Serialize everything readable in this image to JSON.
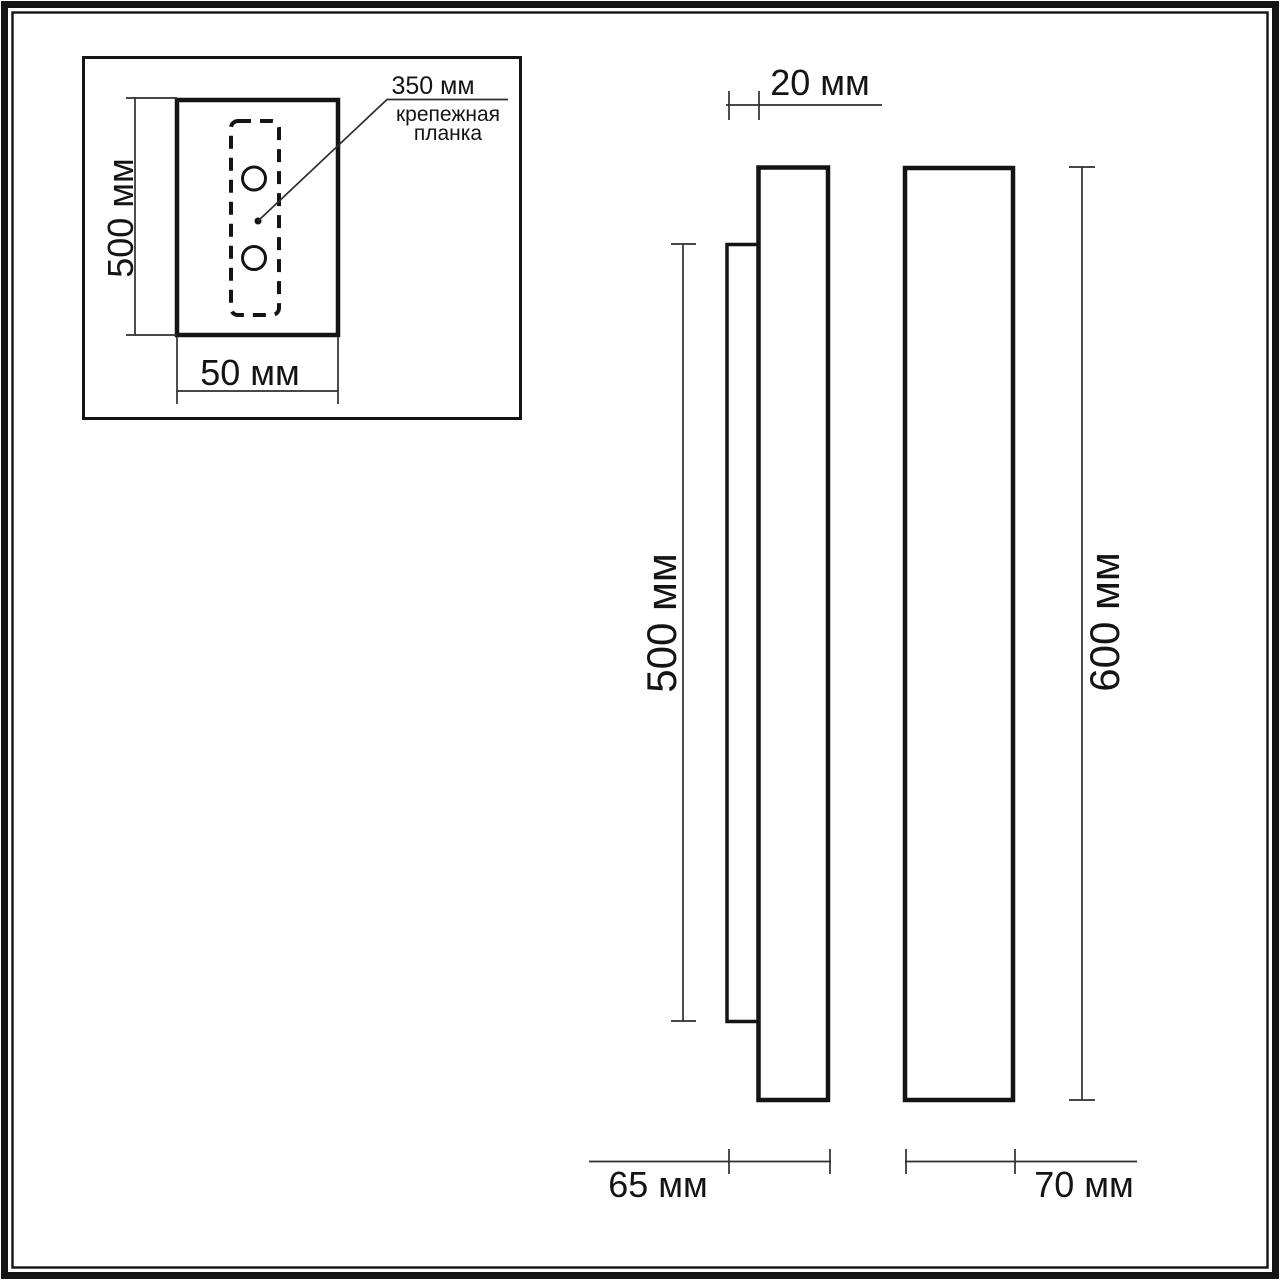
{
  "page": {
    "background": "#ffffff",
    "line_color": "#141414",
    "dim_line_color": "#2e2e2e"
  },
  "inset": {
    "height_label": "500 мм",
    "width_label": "50 мм",
    "leader_value": "350 мм",
    "leader_note_line1": "крепежная",
    "leader_note_line2": "планка"
  },
  "side_profile_view": {
    "plate_depth_label": "20 мм",
    "plate_height_label": "500 мм",
    "total_depth_label": "65 мм"
  },
  "front_elevation_view": {
    "height_label": "600 мм",
    "width_label": "70 мм"
  }
}
